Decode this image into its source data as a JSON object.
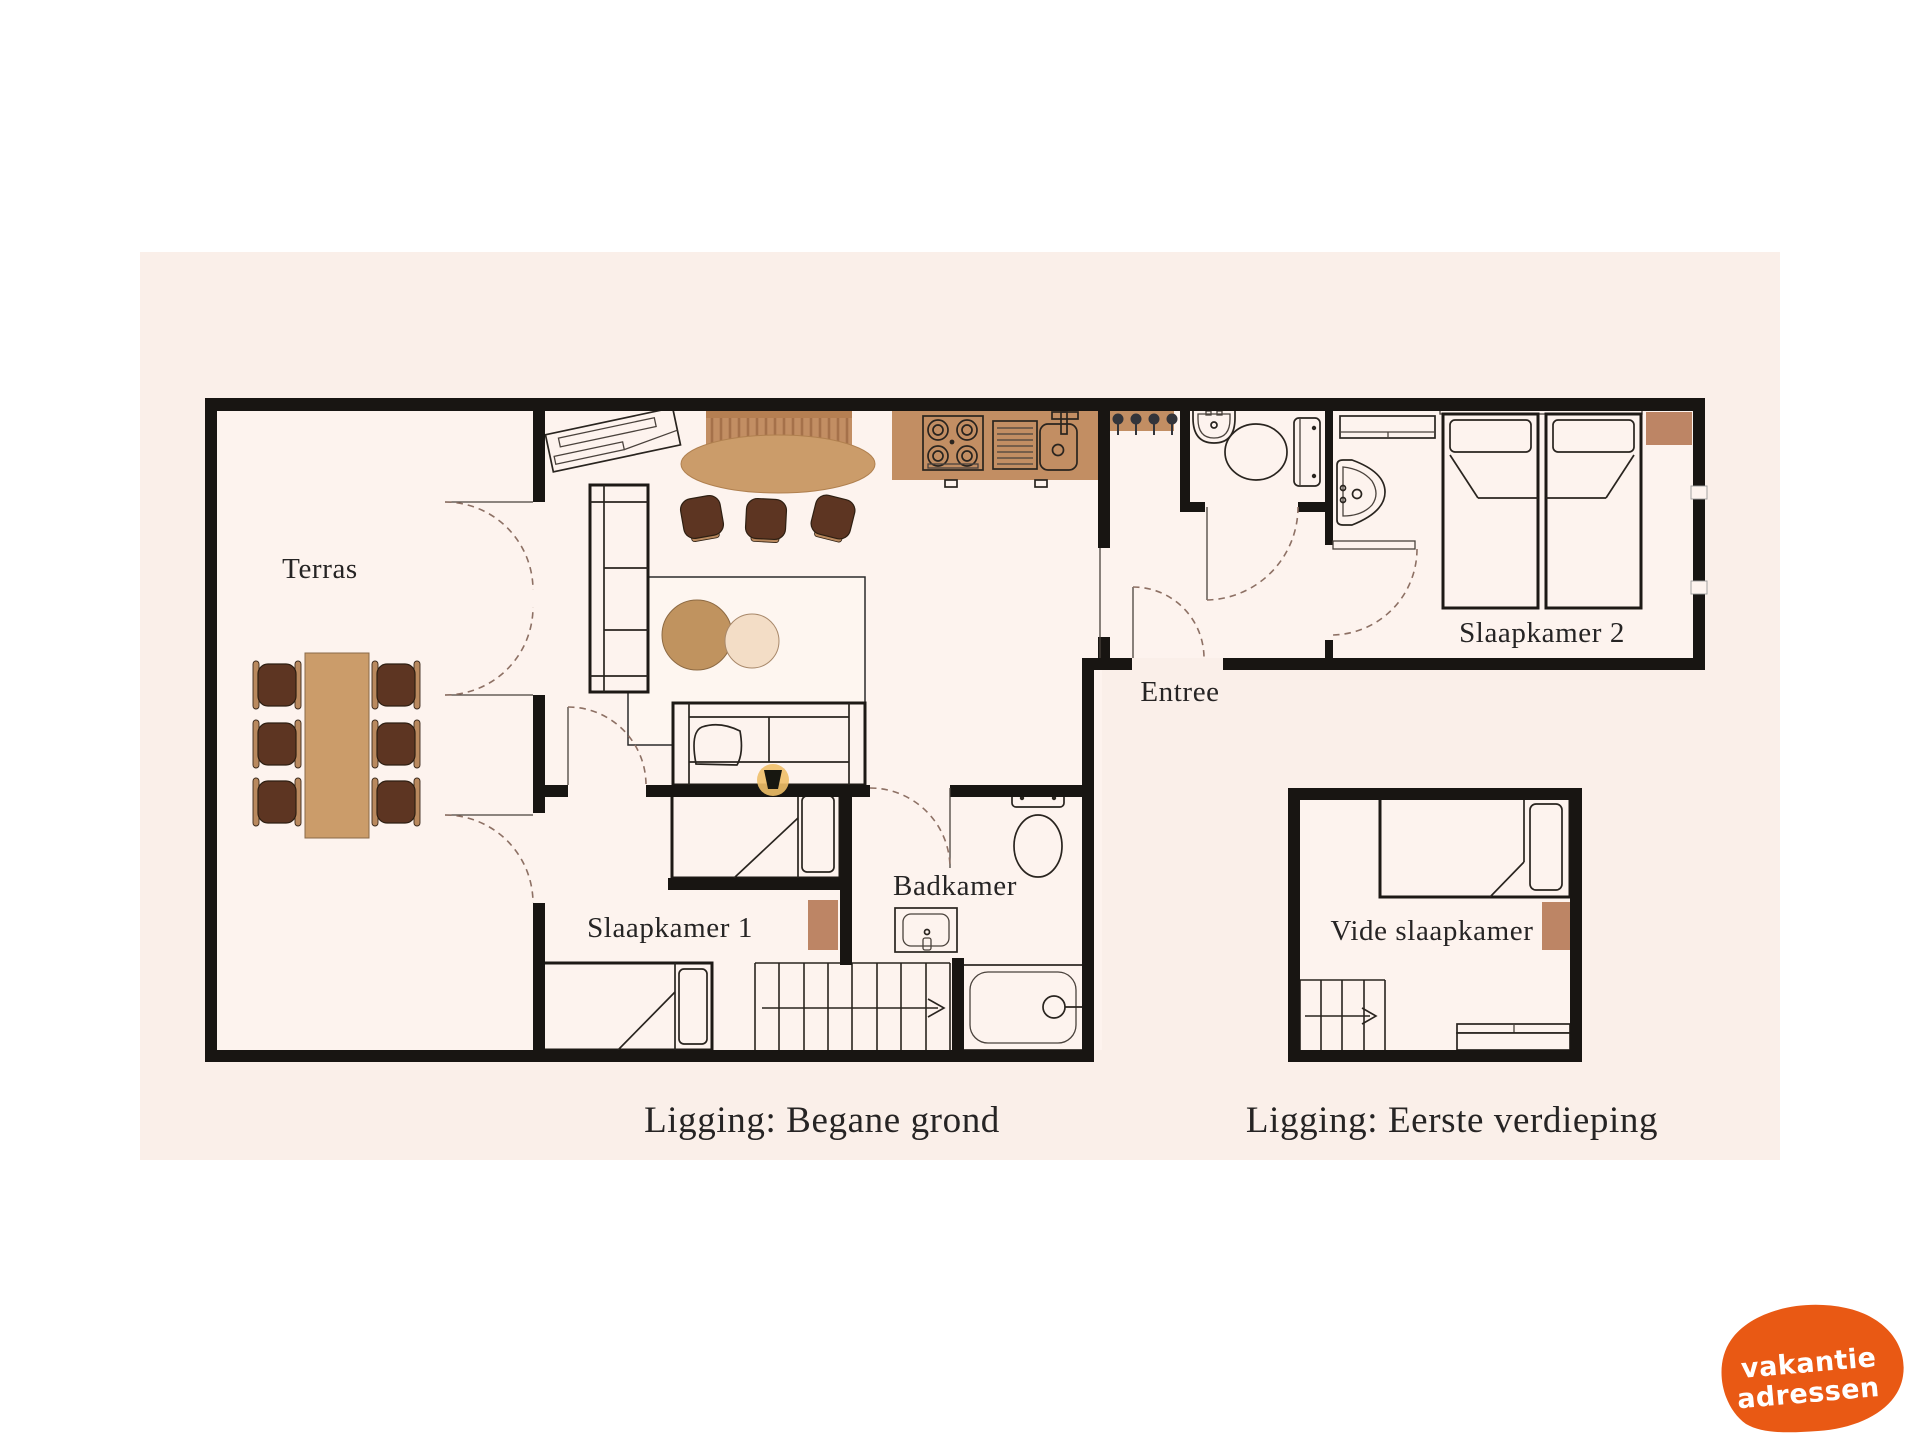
{
  "rooms": {
    "terras": "Terras",
    "slaapkamer1": "Slaapkamer 1",
    "badkamer": "Badkamer",
    "entree": "Entree",
    "slaapkamer2": "Slaapkamer 2",
    "vide": "Vide slaapkamer"
  },
  "captions": {
    "ground": "Ligging: Begane grond",
    "first": "Ligging: Eerste verdieping"
  },
  "logo": {
    "line1": "vakantie",
    "line2": "adressen"
  },
  "icons": {
    "stairs_direction": "arrow-right"
  },
  "colors": {
    "board": "#faefe9",
    "floor": "#fdf3ee",
    "wall": "#181512",
    "counter": "#c28e63",
    "stripe": "#a5714a",
    "wood": "#cb9c6a",
    "chair": "#5d3522",
    "chair_trim": "#b9895e",
    "rug": "#bd8565",
    "rug_round_big": "#c0935f",
    "rug_round_small": "#f3ddc6",
    "lamp": "#f0bf68",
    "logo": "#e95914",
    "ink": "#262424"
  }
}
